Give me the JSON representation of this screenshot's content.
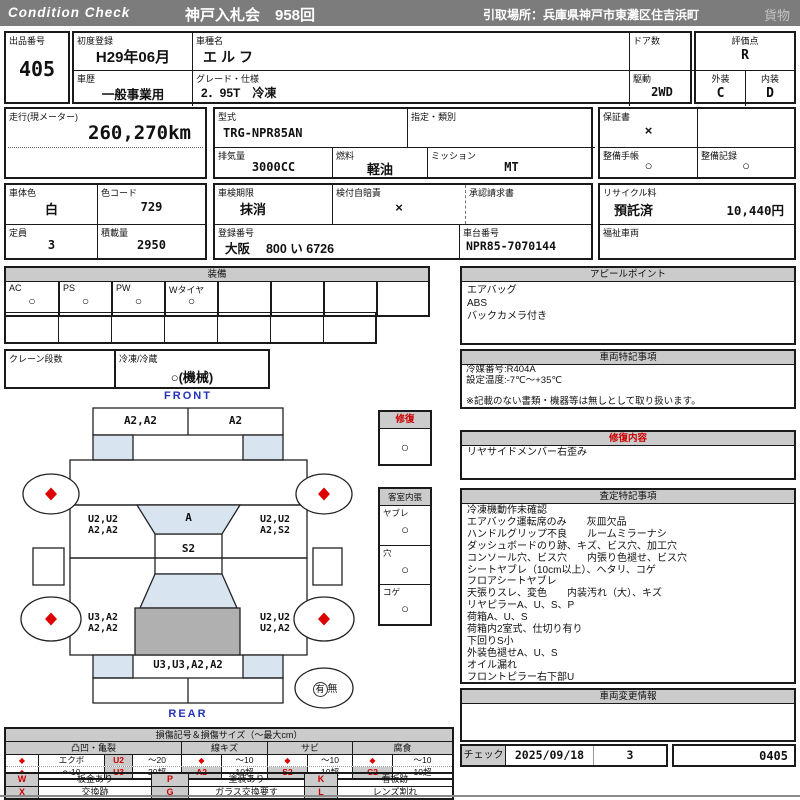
{
  "colors": {
    "header_bar": "#7c7c7c",
    "section_header": "#cbcbcb",
    "accent_red": "#cc0000",
    "diagram_blue_shade": "#d9e4f1",
    "diagram_gray_shade": "#b0b0b0",
    "label_blue": "#2233bb"
  },
  "header": {
    "brand": "Condition  Check",
    "auction": "神戸入札会　958回",
    "pickup": "引取場所：兵庫県神戸市東灘区住吉浜町",
    "category": "貨物"
  },
  "info": {
    "lot_label": "出品番号",
    "lot": "405",
    "first_reg_label": "初度登録",
    "first_reg": "H29年06月",
    "model_label": "車種名",
    "model": "エルフ",
    "history_label": "車歴",
    "history": "一般事業用",
    "grade_label": "グレード・仕様",
    "grade": "2．95T　冷凍",
    "doors_label": "ドア数",
    "doors": "",
    "score_label": "評価点",
    "score": "R",
    "drive_label": "駆動",
    "drive": "2WD",
    "exterior_label": "外装",
    "exterior": "C",
    "interior_label": "内装",
    "interior": "D",
    "mileage_label": "走行(現メーター)",
    "mileage": "260,270km",
    "model_code_label": "型式",
    "model_code": "TRG-NPR85AN",
    "class_label": "指定・類別",
    "class": "",
    "warranty_label": "保証書",
    "warranty": "×",
    "displacement_label": "排気量",
    "displacement": "3000CC",
    "fuel_label": "燃料",
    "fuel": "軽油",
    "transmission_label": "ミッション",
    "transmission": "MT",
    "service_book_label": "整備手帳",
    "service_book": "○",
    "service_record_label": "整備記録",
    "service_record": "○",
    "body_color_label": "車体色",
    "body_color": "白",
    "color_code_label": "色コード",
    "color_code": "729",
    "inspection_label": "車検期限",
    "inspection": "抹消",
    "insurance_label": "検付自賠責",
    "insurance": "×",
    "approval_label": "承認請求書",
    "approval": "",
    "recycle_label": "リサイクル料",
    "recycle_status": "預託済",
    "recycle_fee": "10,440円",
    "seats_label": "定員",
    "seats": "3",
    "payload_label": "積載量",
    "payload": "2950",
    "reg_no_label": "登録番号",
    "reg_no": "大阪　 800 い 6726",
    "chassis_no_label": "車台番号",
    "chassis_no": "NPR85-7070144",
    "welfare_label": "福祉車両",
    "welfare": ""
  },
  "equipment": {
    "title": "装備",
    "items": [
      {
        "label": "AC",
        "value": "○"
      },
      {
        "label": "PS",
        "value": "○"
      },
      {
        "label": "PW",
        "value": "○"
      },
      {
        "label": "Wタイヤ",
        "value": "○"
      },
      {
        "label": "",
        "value": ""
      },
      {
        "label": "",
        "value": ""
      },
      {
        "label": "",
        "value": ""
      },
      {
        "label": "",
        "value": ""
      }
    ],
    "crane_label": "クレーン段数",
    "crane": "",
    "reefer_label": "冷凍/冷蔵",
    "reefer": "○(機械)"
  },
  "appeal": {
    "title": "アピールポイント",
    "lines": [
      "エアバッグ",
      "ABS",
      "バックカメラ付き"
    ]
  },
  "vehicle_notes": {
    "title": "車両特記事項",
    "lines": [
      "冷媒番号:R404A",
      "設定温度:-7℃～+35℃",
      "",
      "※記載のない書類・機器等は無しとして取り扱います。"
    ]
  },
  "repair": {
    "label": "修復",
    "value": "○"
  },
  "repair_detail": {
    "title": "修復内容",
    "lines": [
      "リヤサイドメンバー右歪み"
    ]
  },
  "cabin": {
    "title": "客室内張",
    "items": [
      {
        "label": "ヤブレ",
        "value": "○"
      },
      {
        "label": "穴",
        "value": "○"
      },
      {
        "label": "コゲ",
        "value": "○"
      }
    ]
  },
  "assessment": {
    "title": "査定特記事項",
    "lines": [
      "冷凍機動作未確認",
      "エアバック運転席のみ　　灰皿欠品",
      "ハンドルグリップ不良　　ルームミラーナシ",
      "ダッシュボードのり跡、キズ、ビス穴、加工穴",
      "コンソール穴、ビス穴　　内張り色褪せ、ビス穴",
      "シートヤブレ（10cm以上）、ヘタリ、コゲ",
      "フロアシートヤブレ",
      "天張りスレ、変色　　内装汚れ（大）、キズ",
      "リヤピラーA、U、S、P",
      "荷箱A、U、S",
      "荷箱内2室式、仕切り有り",
      "下回りS小",
      "外装色褪せA、U、S",
      "オイル漏れ",
      "フロントピラー右下部U"
    ]
  },
  "change_info": {
    "title": "車両変更情報",
    "lines": []
  },
  "check": {
    "label": "チェック",
    "date": "2025/09/18",
    "count": "3",
    "code": "0405"
  },
  "diagram": {
    "front_label": "FRONT",
    "rear_label": "REAR",
    "front_bumper_left": "A2,A2",
    "front_bumper_right": "A2",
    "left_front": [
      "U2,U2",
      "A2,A2"
    ],
    "windshield": "A",
    "roof": "S2",
    "right_front": [
      "U2,U2",
      "A2,S2"
    ],
    "left_rear": [
      "U3,A2",
      "A2,A2"
    ],
    "right_rear": [
      "U2,U2",
      "U2,A2"
    ],
    "rear_panel": "U3,U3,A2,A2",
    "spare_present": "有",
    "spare_absent": "無"
  },
  "legend": {
    "title": "損傷記号＆損傷サイズ（〜最大cm）",
    "groups": [
      {
        "name": "凸凹・亀裂",
        "rows": [
          [
            "◆",
            "エクボ",
            "U2",
            "〜20"
          ],
          [
            "◆",
            "〜10",
            "U3",
            "20超"
          ]
        ]
      },
      {
        "name": "線キズ",
        "rows": [
          [
            "◆",
            "〜10"
          ],
          [
            "A2",
            "10超"
          ]
        ]
      },
      {
        "name": "サビ",
        "rows": [
          [
            "◆",
            "〜10"
          ],
          [
            "S2",
            "10超"
          ]
        ]
      },
      {
        "name": "腐食",
        "rows": [
          [
            "◆",
            "〜10"
          ],
          [
            "C2",
            "10超"
          ]
        ]
      }
    ],
    "codes": [
      [
        {
          "sym": "W",
          "desc": "板金あり"
        },
        {
          "sym": "P",
          "desc": "塗装あり"
        },
        {
          "sym": "K",
          "desc": "看板跡"
        }
      ],
      [
        {
          "sym": "X",
          "desc": "交換跡"
        },
        {
          "sym": "G",
          "desc": "ガラス交換要す"
        },
        {
          "sym": "L",
          "desc": "レンズ割れ"
        }
      ]
    ]
  }
}
